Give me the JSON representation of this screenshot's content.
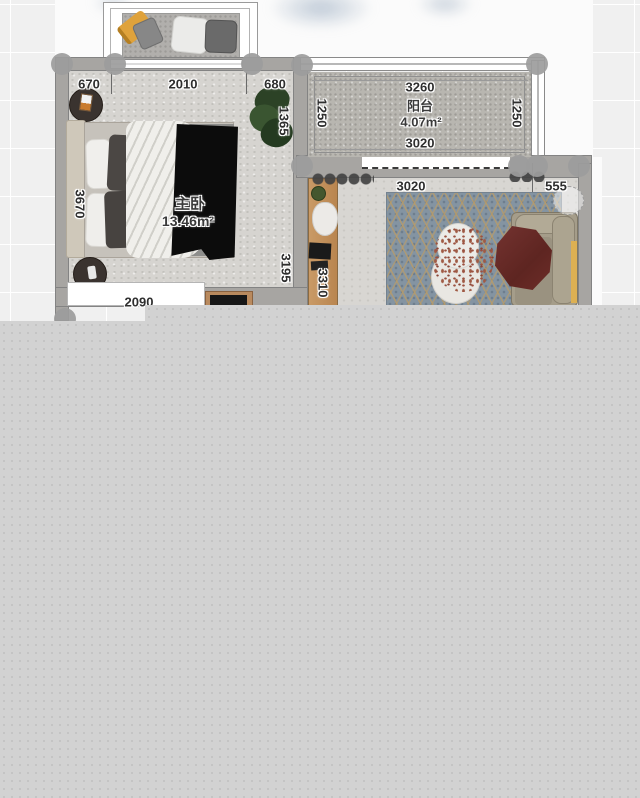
{
  "app": {
    "view": "floorplan-2d-editor"
  },
  "rooms": {
    "bedroom": {
      "name": "主卧",
      "area": "13.46m²"
    },
    "balcony": {
      "name": "阳台",
      "area": "4.07m²"
    }
  },
  "dims": {
    "bedroom_top_left": "670",
    "bedroom_top_mid": "2010",
    "bedroom_top_right": "680",
    "bedroom_right_upper": "1365",
    "bedroom_left": "3670",
    "bedroom_right_lower": "3195",
    "bedroom_bottom": "2090",
    "balcony_top": "3260",
    "balcony_bottom": "3020",
    "balcony_left": "1250",
    "balcony_right": "1250",
    "living_top": "3020",
    "living_top_right": "555",
    "living_left": "3310"
  },
  "colors": {
    "canvas_bg": "#f0f0f0",
    "grid_line": "#ffffff",
    "wall": "#a7a5a2",
    "overlay": "#d2d2d2",
    "rug_blue": "#8494a2",
    "rug_lattice_tan": "#ba9c68",
    "maroon_throw": "#6d2d28",
    "yellow_pillow": "#dfa23b",
    "sofa_beige": "#a59d8a",
    "desk_wood": "#c4915c"
  }
}
